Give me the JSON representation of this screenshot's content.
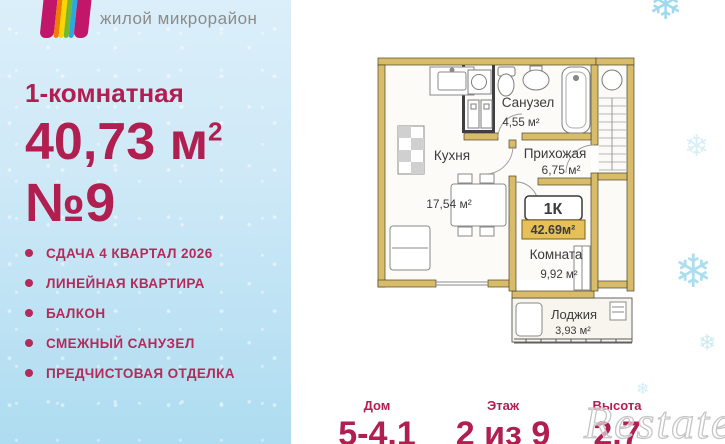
{
  "brand": {
    "logo_subtitle": "жилой микрорайон",
    "logo_colors": [
      "#c2166b",
      "#f07c00",
      "#ffd400",
      "#76b82a",
      "#2aa9e0",
      "#c2166b"
    ]
  },
  "left_panel": {
    "type_label": "1-комнатная",
    "area_value": "40,73 м",
    "area_sup": "2",
    "unit_number": "№9",
    "features": [
      "СДАЧА 4 КВАРТАЛ 2026",
      "ЛИНЕЙНАЯ КВАРТИРА",
      "БАЛКОН",
      "СМЕЖНЫЙ САНУЗЕЛ",
      "ПРЕДЧИСТОВАЯ ОТДЕЛКА"
    ]
  },
  "floor_plan": {
    "rooms": [
      {
        "name": "Кухня",
        "area": "17,54 м²"
      },
      {
        "name": "Санузел",
        "area": "4,55 м²"
      },
      {
        "name": "Прихожая",
        "area": "6,75 м²"
      },
      {
        "name": "Комната",
        "area": "9,92 м²"
      },
      {
        "name": "Лоджия",
        "area": "3,93 м²"
      }
    ],
    "badge": {
      "type": "1К",
      "total_area": "42.69м²"
    }
  },
  "stats": [
    {
      "label": "Дом",
      "value": "5-4.1"
    },
    {
      "label": "Этаж",
      "value": "2 из 9"
    },
    {
      "label": "Высота",
      "value": "2,7"
    }
  ],
  "watermark": "Restate",
  "icons": {
    "snowflake": "❄"
  },
  "colors": {
    "accent": "#b01f50",
    "wall": "#d9bc6a",
    "panel_blue": "#cfe9f7",
    "snowflake": "#8ed3ec",
    "badge_bar": "#e6c058"
  }
}
